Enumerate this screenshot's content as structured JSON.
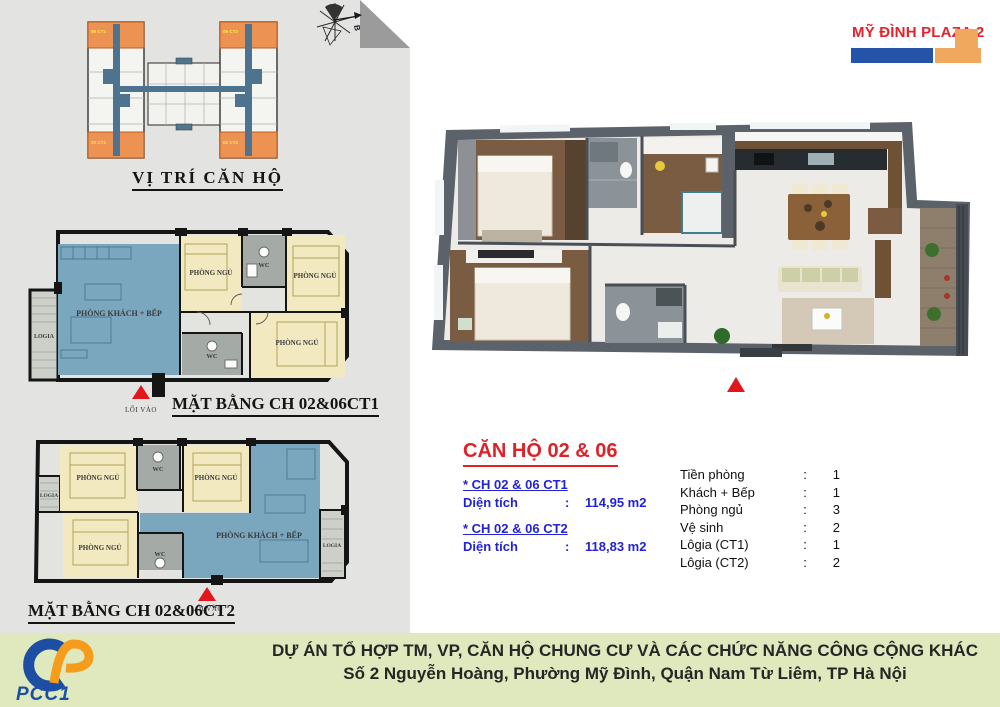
{
  "brand": {
    "name": "MỸ ĐÌNH PLAZA 2",
    "red": "#e62129",
    "blue": "#2553a8",
    "orange": "#f0a85e"
  },
  "locator": {
    "title": "VỊ TRÍ CĂN HỘ",
    "compass": "B",
    "units": [
      "06 CT1",
      "02 CT1",
      "06 CT2",
      "02 CT2"
    ]
  },
  "labels": {
    "living": "PHÒNG KHÁCH + BẾP",
    "bedroom": "PHÒNG NGỦ",
    "wc": "WC",
    "logia": "LOGIA",
    "entrance": "LỐI VÀO"
  },
  "plans": {
    "ct1": {
      "title": "MẶT BẰNG CH 02&06CT1"
    },
    "ct2": {
      "title": "MẶT BẰNG CH 02&06CT2"
    }
  },
  "info": {
    "title": "CĂN HỘ 02 & 06",
    "colon": ":",
    "variants": [
      {
        "name": "* CH 02 & 06 CT1",
        "field": "Diện tích",
        "value": "114,95 m2"
      },
      {
        "name": "* CH 02 & 06 CT2",
        "field": "Diện tích",
        "value": "118,83 m2"
      }
    ],
    "specs": [
      {
        "label": "Tiền phòng",
        "value": "1"
      },
      {
        "label": "Khách + Bếp",
        "value": "1"
      },
      {
        "label": "Phòng ngủ",
        "value": "3"
      },
      {
        "label": "Vệ sinh",
        "value": "2"
      },
      {
        "label": "Lôgia (CT1)",
        "value": "1"
      },
      {
        "label": "Lôgia (CT2)",
        "value": "2"
      }
    ]
  },
  "footer": {
    "logo": "PCC1",
    "line1": "DỰ ÁN TỔ HỢP TM, VP, CĂN HỘ CHUNG CƯ VÀ CÁC CHỨC NĂNG CÔNG CỘNG KHÁC",
    "line2": "Số 2 Nguyễn Hoàng, Phường Mỹ Đình, Quận Nam Từ Liêm, TP Hà Nội"
  }
}
